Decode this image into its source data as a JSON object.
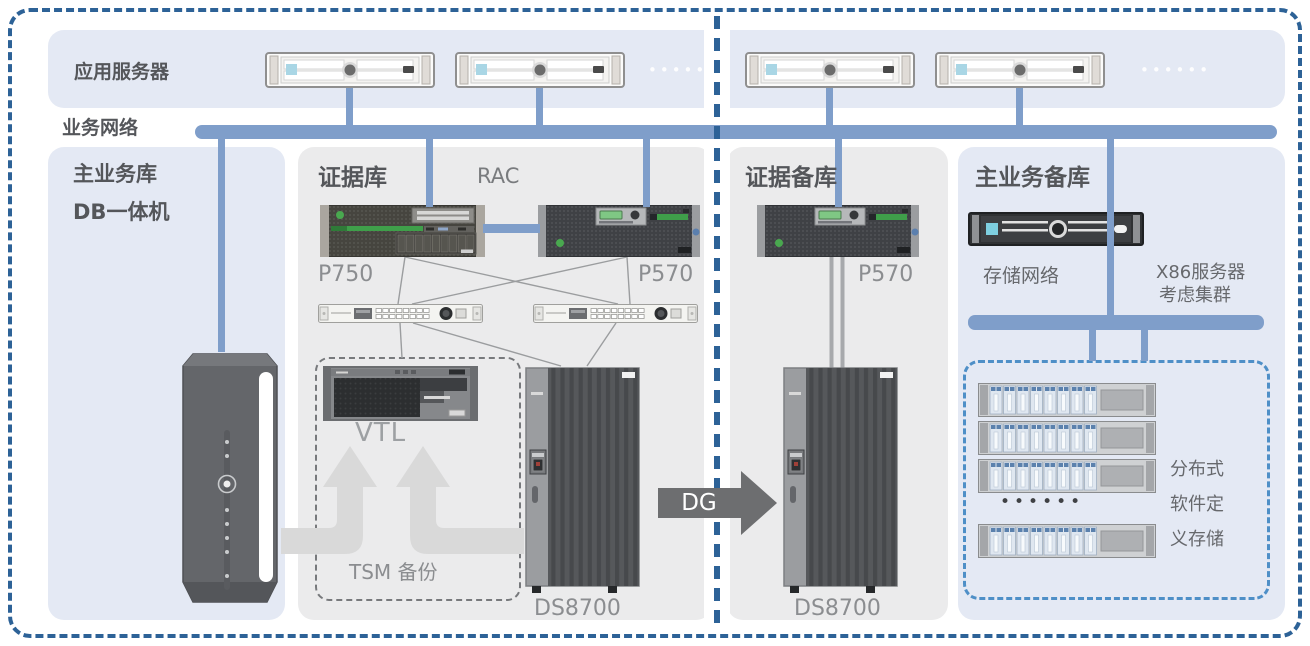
{
  "app_tier": {
    "label": "应用服务器",
    "dots_left": "••••••",
    "dots_right": "••••••"
  },
  "business_network": {
    "label": "业务网络"
  },
  "primary_db": {
    "title": "主业务库",
    "subtitle": "DB一体机"
  },
  "evidence_db": {
    "title": "证据库",
    "rac": "RAC",
    "server1_label": "P750",
    "server2_label": "P570",
    "vtl": "VTL",
    "tsm": "TSM 备份",
    "storage_label": "DS8700"
  },
  "replication": {
    "dg": "DG"
  },
  "evidence_backup": {
    "title": "证据备库",
    "server_label": "P570",
    "storage_label": "DS8700"
  },
  "primary_backup": {
    "title": "主业务备库",
    "storage_network": "存储网络",
    "x86_line1": "X86服务器",
    "x86_line2": "考虑集群",
    "sds_line1": "分布式",
    "sds_line2": "软件定",
    "sds_line3": "义存储",
    "dots": "••••••"
  },
  "colors": {
    "accent_blue": "#7f9eca",
    "border_blue": "#2d6297",
    "panel_blue": "#e4e9f4",
    "panel_grey": "#ebebec",
    "dashed_box_blue": "#4e8fc7",
    "arrow_grey": "#d9d9d9",
    "dg_grey": "#6d6e70"
  }
}
